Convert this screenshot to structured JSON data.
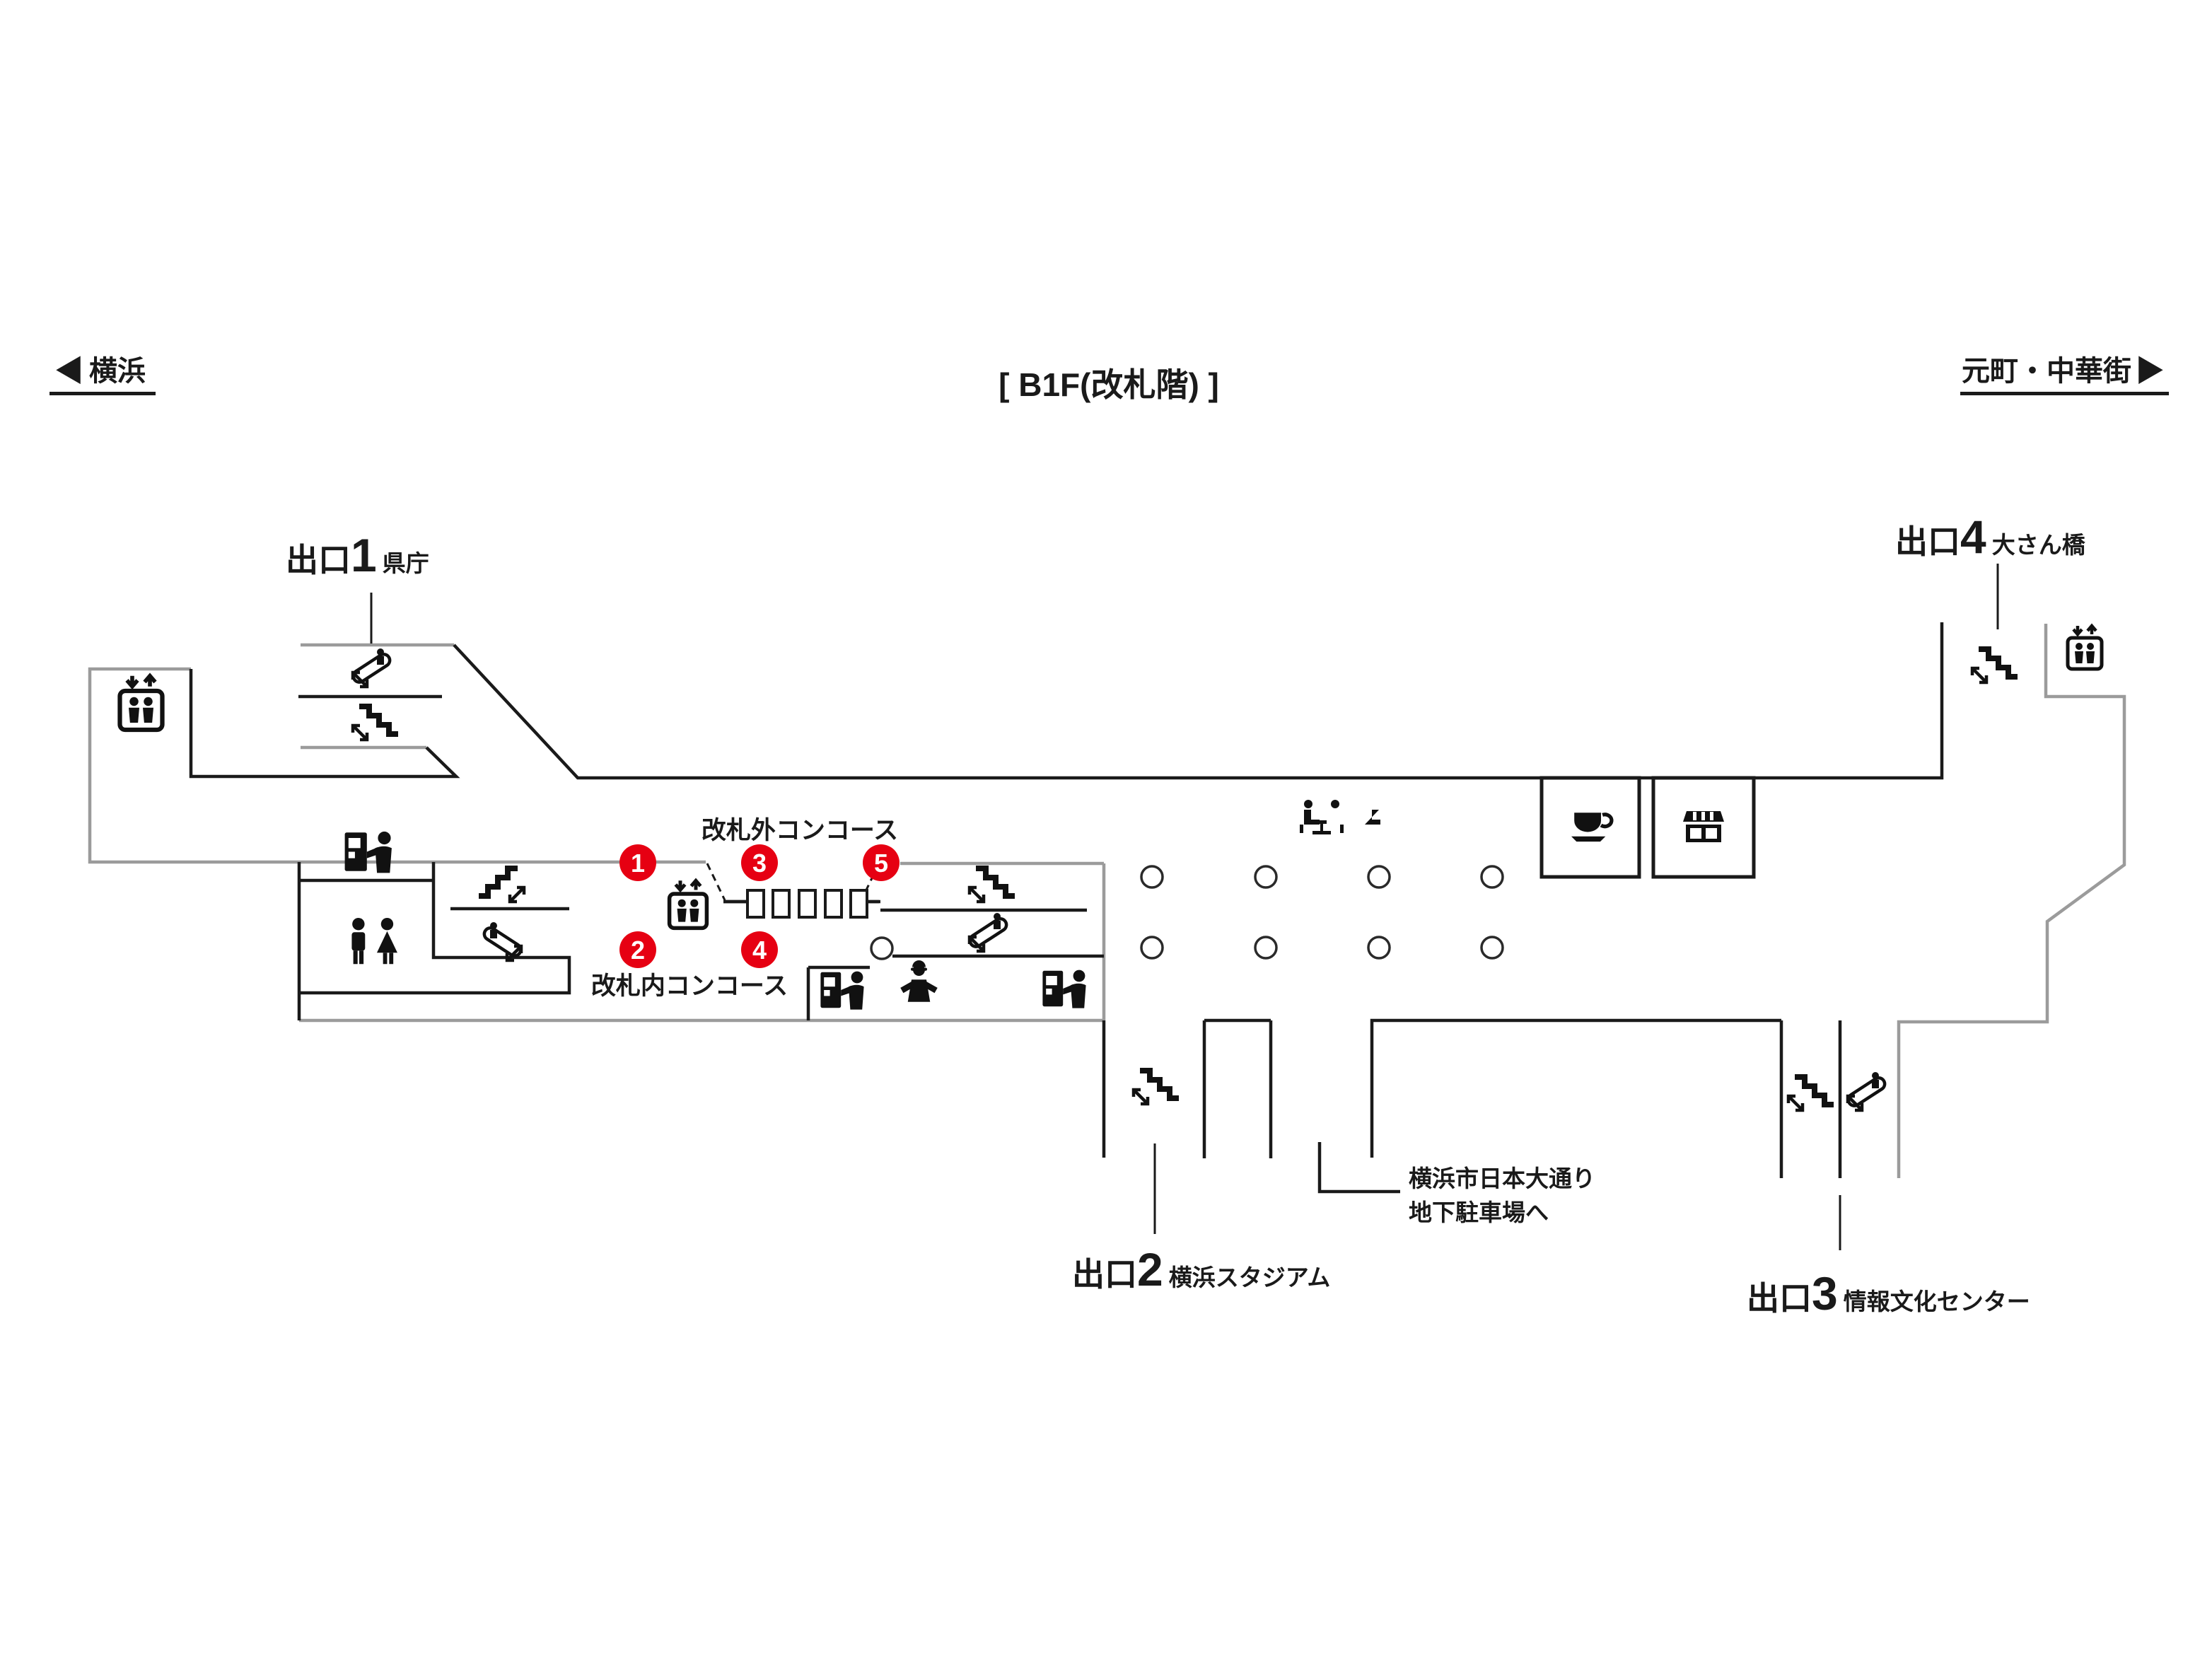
{
  "title": "[ B1F(改札階) ]",
  "nav": {
    "left": {
      "arrow": "◀",
      "label": "横浜"
    },
    "right": {
      "label": "元町・中華街",
      "arrow": "▶"
    }
  },
  "exits": [
    {
      "prefix": "出口",
      "number": "1",
      "name": "県庁"
    },
    {
      "prefix": "出口",
      "number": "2",
      "name": "横浜スタジアム"
    },
    {
      "prefix": "出口",
      "number": "3",
      "name": "情報文化センター"
    },
    {
      "prefix": "出口",
      "number": "4",
      "name": "大さん橋"
    }
  ],
  "concourse": {
    "outside_gates": "改札外コンコース",
    "inside_gates": "改札内コンコース"
  },
  "parking_note": {
    "line1": "横浜市日本大通り",
    "line2": "地下駐車場へ"
  },
  "numbered_points": [
    "1",
    "2",
    "3",
    "4",
    "5"
  ],
  "icons": {
    "stairs-icon": "staircase with up/down double arrow",
    "escalator-icon": "slanted escalator with rider and double arrow",
    "elevator-icon": "car with two people and down/up arrows",
    "toilet-icon": "man and woman pictogram",
    "ticket-machine-icon": "vending machine with person",
    "station-staff-icon": "staff member with cap and open arms",
    "bench-icon": "two seated people (rest area)",
    "cafe-icon": "coffee cup on saucer",
    "shop-icon": "storefront with awning",
    "pillar": "small circle (column)"
  },
  "colors": {
    "point_red": "#e60012",
    "wall_gray": "#9b9b9b",
    "wall_black": "#1a1a1a",
    "icon_black": "#111111"
  }
}
